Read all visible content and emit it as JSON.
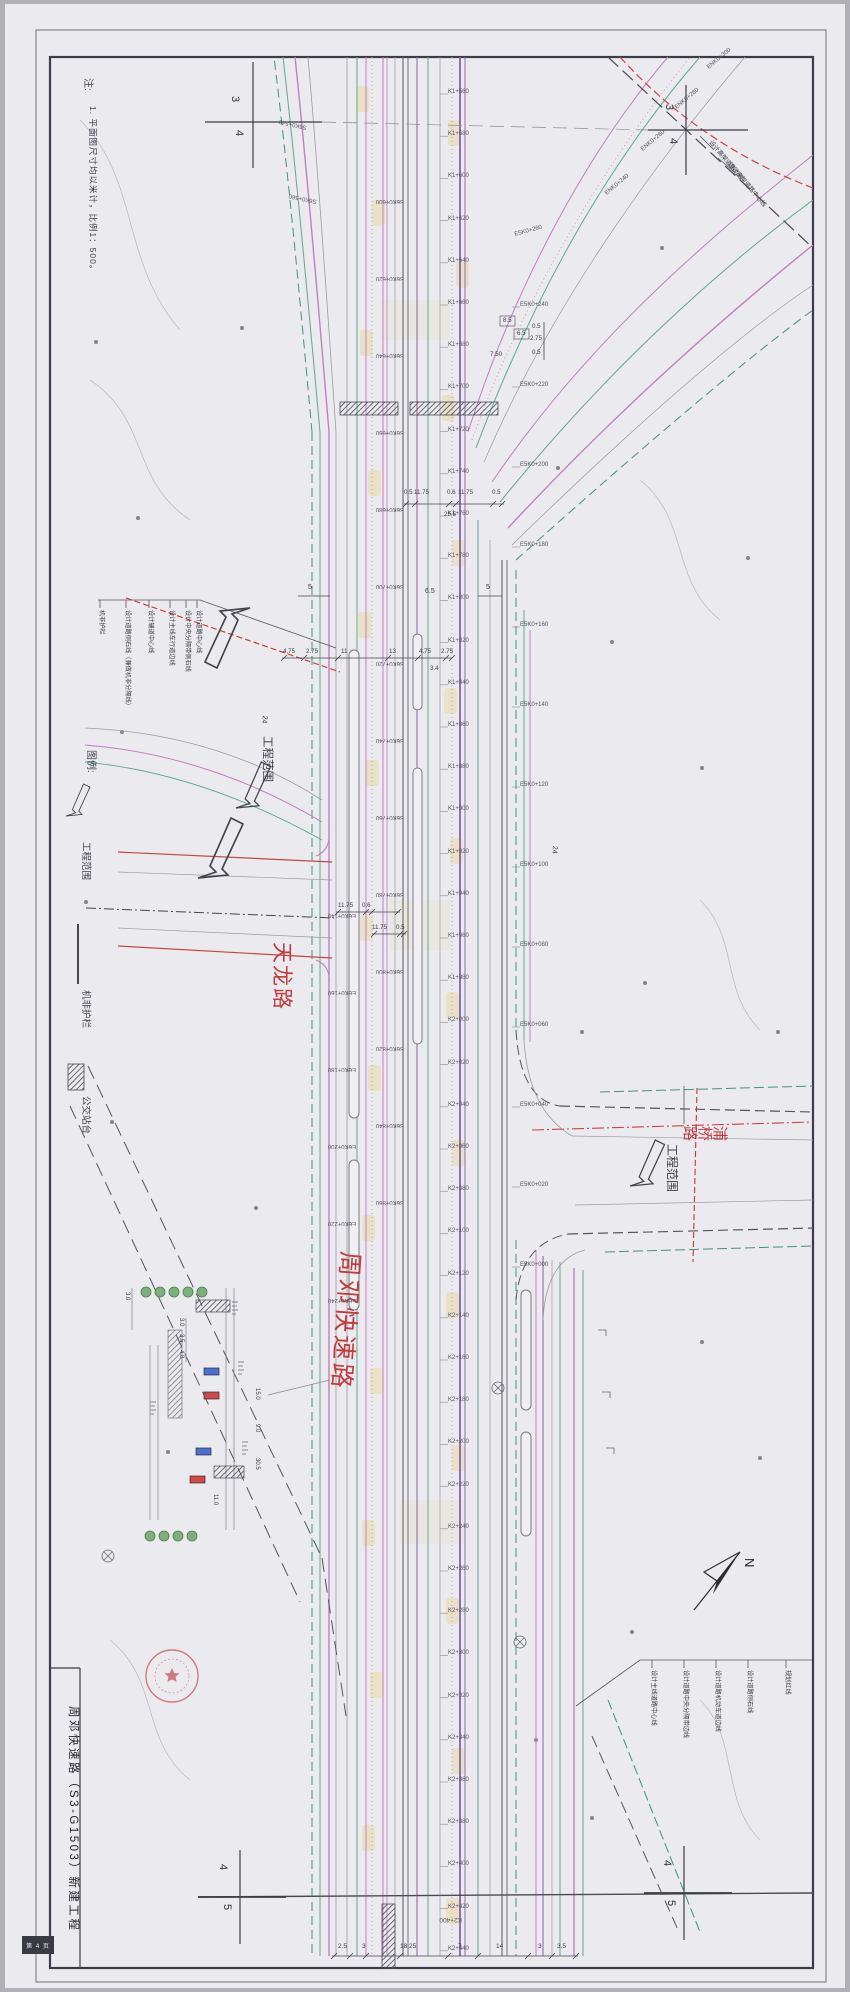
{
  "page": {
    "title_block": "周邓快速路（S3-G1503）新建工程",
    "corner_box": "第 4 页"
  },
  "notes": {
    "heading": "注:",
    "item": "1. 平面图尺寸均以米计，比例1：500。"
  },
  "legend": {
    "heading": "图例:",
    "items": [
      {
        "symbol": "boundary-arrow",
        "label": "工程范围"
      },
      {
        "symbol": "barrier-line",
        "label": "机非护栏"
      },
      {
        "symbol": "platform-hatch",
        "label": "公交站台"
      }
    ]
  },
  "road_names": {
    "tianlong": "天龙路",
    "zhoudeng": "周邓快速路",
    "puqiao": "浦桥路"
  },
  "boundary_marker": "工程范围",
  "compass": "N",
  "section_markers": {
    "top_left": [
      "3",
      "4"
    ],
    "top_right": [
      "3",
      "4"
    ],
    "bottom_left": [
      "4",
      "5"
    ],
    "bottom_right": [
      "4",
      "5"
    ]
  },
  "callouts": {
    "left": [
      "机非护栏",
      "设计道路侧石线（兼做机非分隔线）",
      "设计辅道中心线",
      "设计主线车行道边线",
      "设计中央分隔带侧石线",
      "设计道路中心线"
    ],
    "right": [
      "设计主线道路中心线",
      "设计道路中央分隔带边线",
      "设计道路机动车道边线",
      "设计道路侧石线",
      "规划红线"
    ],
    "ramp": [
      "设计高架道路边线",
      "设计高架道路中心线"
    ]
  },
  "stations": {
    "center": [
      "K1+560",
      "K1+580",
      "K1+600",
      "K1+620",
      "K1+640",
      "K1+660",
      "K1+680",
      "K1+700",
      "K1+720",
      "K1+740",
      "K1+760",
      "K1+780",
      "K1+800",
      "K1+820",
      "K1+840",
      "K1+860",
      "K1+880",
      "K1+900",
      "K1+920",
      "K1+940",
      "K1+960",
      "K1+980",
      "K2+000",
      "K2+020",
      "K2+040",
      "K2+060",
      "K2+080",
      "K2+100",
      "K2+120",
      "K2+140",
      "K2+160",
      "K2+180",
      "K2+200",
      "K2+220",
      "K2+240",
      "K2+260",
      "K2+280",
      "K2+300",
      "K2+320",
      "K2+340",
      "K2+360",
      "K2+380",
      "K2+400",
      "K2+420",
      "K2+440"
    ],
    "left": [
      "S6K0+600",
      "S6K0+620",
      "S6K0+640",
      "S6K0+660",
      "S6K0+680",
      "S6K0+700",
      "S6K0+720",
      "S6K0+740",
      "S6K0+760",
      "S6K0+780",
      "S6K0+800",
      "S6K0+820",
      "S6K0+840",
      "S6K0+860"
    ],
    "left2": [
      "E6K0+140",
      "E6K0+160",
      "E6K0+180",
      "E6K0+200",
      "E6K0+220",
      "E6K0+240"
    ],
    "right": [
      "E5K0+240",
      "E5K0+220",
      "E5K0+200",
      "E5K0+180",
      "E5K0+160",
      "E5K0+140",
      "E5K0+120",
      "E5K0+100",
      "E5K0+080",
      "E5K0+060",
      "E5K0+040",
      "E5K0+020",
      "E5K0+000"
    ],
    "ramp": [
      "ENK0+240",
      "ENK0+260",
      "ENK0+280",
      "ENK0+300"
    ],
    "top_left_ramp": [
      "S6K0+540",
      "S6K0+560"
    ],
    "right_extra": "E5K0+260",
    "bottom_flipped": "K2+400"
  },
  "dimensions": {
    "row1": [
      "0.5",
      "11.75",
      "0.6",
      "11.75",
      "0.5"
    ],
    "row1_total": "25.5",
    "row2": [
      "4.75",
      "2.75",
      "11",
      "13",
      "4.75",
      "2.75"
    ],
    "row2_extra": "3.4",
    "row3a": [
      "11.75",
      "0.6"
    ],
    "row3b": [
      "11.75",
      "0.5"
    ],
    "bottom": [
      "2.5",
      "3",
      "18.25",
      "7",
      "14",
      "3",
      "3.5"
    ],
    "boxed": [
      "8.5",
      "6.5"
    ],
    "stack": [
      "0.5",
      "2.75",
      "0.5"
    ],
    "extra": "7.50",
    "mid": [
      "5",
      "6.5",
      "5"
    ],
    "offset": "24",
    "bus_detail": [
      "3.0",
      "3.0",
      "3.5",
      "4.8",
      "15.0",
      "9.0",
      "30.5",
      "11.0"
    ]
  },
  "colors": {
    "pink": "#c47fc0",
    "green": "#62a98f",
    "teal": "#3e9677",
    "gray": "#9a9aa4",
    "dark": "#55555f",
    "purple": "#8b5fb0",
    "red": "#c84545",
    "yellow": "#e9dba6"
  }
}
